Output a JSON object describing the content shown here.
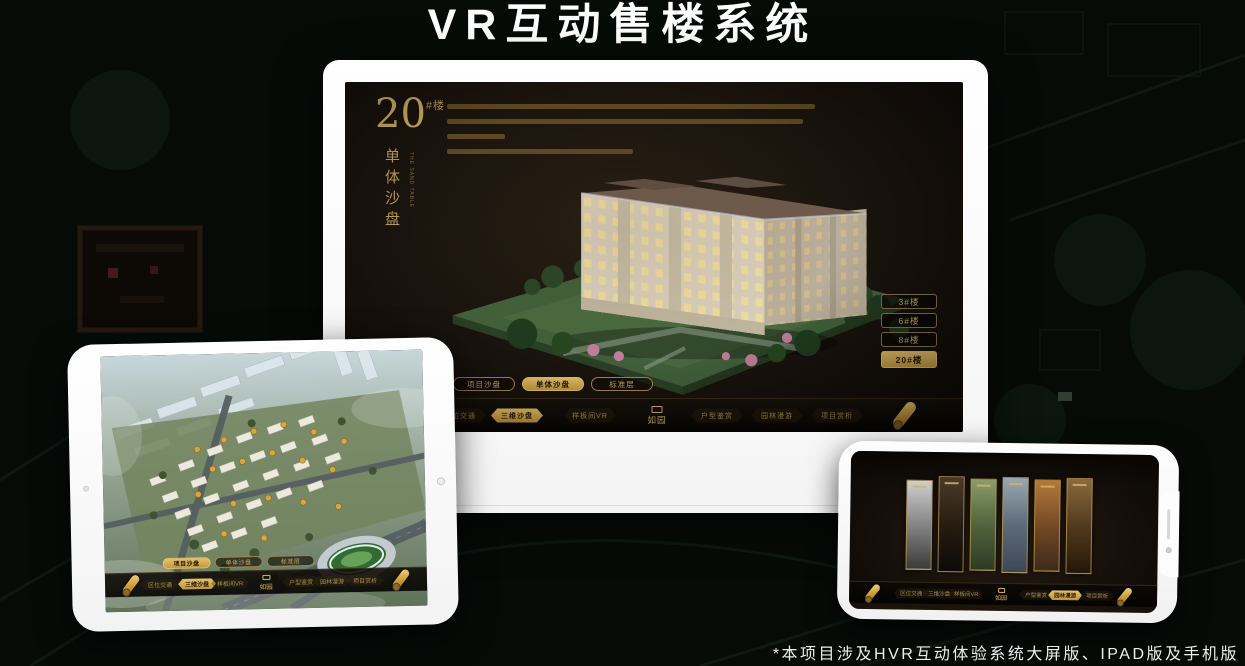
{
  "title": "VR互动售楼系统",
  "footnote": "*本项目涉及HVR互动体验系统大屏版、IPAD版及手机版",
  "brand": {
    "logo": "如园"
  },
  "app_tabs": [
    "项目沙盘",
    "单体沙盘",
    "标准层"
  ],
  "app_nav": {
    "items": [
      "区位交通",
      "三维沙盘",
      "样板间VR",
      "户型鉴赏",
      "园林漫游",
      "项目赏析"
    ]
  },
  "monitor_app": {
    "headline": {
      "number": "20",
      "suffix": "#楼",
      "vertical": "单体沙盘",
      "caption": "THE SAND TABLE"
    },
    "floor_buttons": [
      {
        "label": "3#楼",
        "selected": false
      },
      {
        "label": "6#楼",
        "selected": false
      },
      {
        "label": "8#楼",
        "selected": false
      },
      {
        "label": "20#楼",
        "selected": true
      }
    ],
    "selected_tab": "单体沙盘",
    "selected_nav": "三维沙盘"
  },
  "tablet_app": {
    "selected_tab": "项目沙盘",
    "selected_nav": "三维沙盘"
  },
  "phone_app": {
    "selected_nav": "园林漫游"
  },
  "colors": {
    "gold": "#c9a14f",
    "screen_bg": "#1a1410",
    "page_bg": "#070b08"
  }
}
